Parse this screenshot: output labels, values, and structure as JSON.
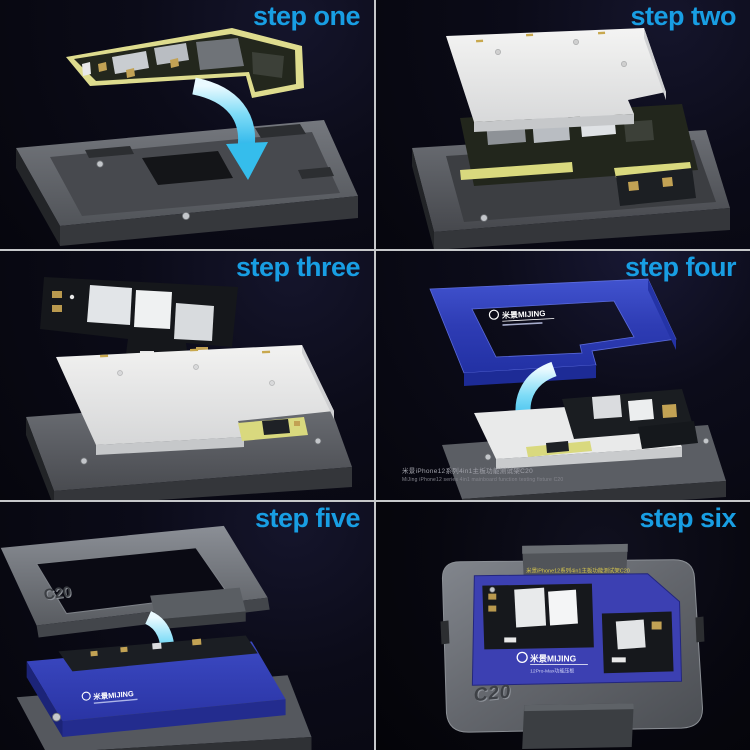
{
  "title": "Six-step usage guide for motherboard layered test fixture",
  "colors": {
    "background": "#07070f",
    "divider": "#c6c8ca",
    "step_label": "#189ee3",
    "arrow_cyan": "#35bdec",
    "frame_blue": "#2e3cb4",
    "pcb_edge_yellow": "#d9d97e",
    "fixture_gray": "#62656b",
    "cover_white": "#ececeb"
  },
  "panels": [
    {
      "id": "step-one",
      "label": "step one",
      "alt": "L-shaped lower logic board lowered by cyan arrow into gray fixture base"
    },
    {
      "id": "step-two",
      "label": "step two",
      "alt": "logic board seated in fixture with white insulation cover tilted above it"
    },
    {
      "id": "step-three",
      "label": "step three",
      "alt": "upper logic board floating above fixture fitted with white insulation cover"
    },
    {
      "id": "step-four",
      "label": "step four",
      "frame_brand": "米景MIJING",
      "caption_line1": "米景iPhone12系列4in1主板功能测试架C20",
      "caption_line2": "MiJing iPhone12 series 4in1 mainboard function testing fixture C20",
      "alt": "blue pressing frame lowered by cyan arrow onto stacked boards in fixture"
    },
    {
      "id": "step-five",
      "label": "step five",
      "frame_marking": "C20",
      "brand": "米景MIJING",
      "alt": "metal clamp frame lowered by cyan arrow onto blue pressing plate"
    },
    {
      "id": "step-six",
      "label": "step six",
      "marking": "C20",
      "brand": "米景MIJING",
      "brand_sub": "12Pro-Max功能压板",
      "top_text": "米景iPhone12系列4in1主板功能测试架C20",
      "alt": "fully assembled C20 test fixture seen from above"
    }
  ]
}
